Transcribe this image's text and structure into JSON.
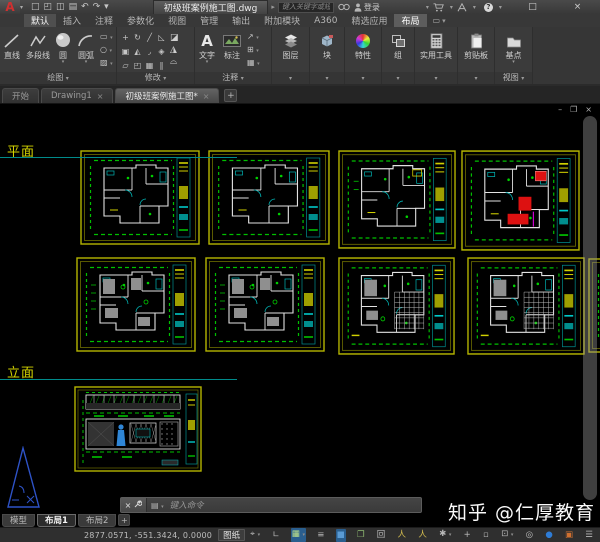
{
  "titlebar": {
    "logo_letter": "A",
    "qat_icons": [
      {
        "name": "new-file-icon",
        "glyph": "□"
      },
      {
        "name": "open-file-icon",
        "glyph": "◰"
      },
      {
        "name": "save-icon",
        "glyph": "◫"
      },
      {
        "name": "plot-icon",
        "glyph": "▤"
      },
      {
        "name": "undo-icon",
        "glyph": "↶"
      },
      {
        "name": "redo-icon",
        "glyph": "↷"
      },
      {
        "name": "qat-dropdown-icon",
        "glyph": "▾"
      }
    ],
    "doc_title": "初级班案例施工图.dwg",
    "search_placeholder": "键入关键字或短语",
    "signin_label": "登录",
    "window_controls": {
      "minimize": "–",
      "maximize": "□",
      "close": "×"
    }
  },
  "ribbon": {
    "tabs": [
      {
        "label": "默认",
        "state": "active"
      },
      {
        "label": "插入",
        "state": ""
      },
      {
        "label": "注释",
        "state": ""
      },
      {
        "label": "参数化",
        "state": ""
      },
      {
        "label": "视图",
        "state": ""
      },
      {
        "label": "管理",
        "state": ""
      },
      {
        "label": "输出",
        "state": ""
      },
      {
        "label": "附加模块",
        "state": ""
      },
      {
        "label": "A360",
        "state": ""
      },
      {
        "label": "精选应用",
        "state": ""
      },
      {
        "label": "布局",
        "state": "selected"
      }
    ],
    "panels": {
      "draw": {
        "label": "绘图",
        "tools": [
          "直线",
          "多段线",
          "圆",
          "圆弧"
        ]
      },
      "modify": {
        "label": "修改"
      },
      "annotate": {
        "label": "注释",
        "tools": [
          "文字",
          "标注"
        ]
      },
      "layers": {
        "label": "图层"
      },
      "block": {
        "label": "块"
      },
      "properties": {
        "label": "特性"
      },
      "group": {
        "label": "组"
      },
      "utilities": {
        "label": "实用工具"
      },
      "clipboard": {
        "label": "剪贴板"
      },
      "view": {
        "label": "视图",
        "tool": "基点"
      }
    },
    "modify_tools": [
      {
        "name": "move-icon",
        "glyph": "+"
      },
      {
        "name": "rotate-icon",
        "glyph": "↻"
      },
      {
        "name": "trim-icon",
        "glyph": "╱"
      },
      {
        "name": "erase-icon",
        "glyph": "◺"
      },
      {
        "name": "copy-icon",
        "glyph": "▣"
      },
      {
        "name": "mirror-icon",
        "glyph": "◭"
      },
      {
        "name": "fillet-icon",
        "glyph": "◞"
      },
      {
        "name": "explode-icon",
        "glyph": "◈"
      },
      {
        "name": "stretch-icon",
        "glyph": "▱"
      },
      {
        "name": "scale-icon",
        "glyph": "◰"
      },
      {
        "name": "array-icon",
        "glyph": "▦"
      },
      {
        "name": "offset-icon",
        "glyph": "∥"
      }
    ],
    "modify_side": [
      {
        "name": "erase-alt-icon",
        "glyph": "◪"
      },
      {
        "name": "join-icon",
        "glyph": "◮"
      },
      {
        "name": "break-icon",
        "glyph": "⌓"
      }
    ],
    "draw_side": [
      {
        "name": "rectangle-icon",
        "glyph": "▭"
      },
      {
        "name": "ellipse-icon",
        "glyph": "○"
      },
      {
        "name": "hatch-icon",
        "glyph": "▨"
      }
    ],
    "annotate_side": [
      {
        "name": "leader-icon",
        "glyph": "↗"
      },
      {
        "name": "table-icon",
        "glyph": "⊞"
      },
      {
        "name": "markup-icon",
        "glyph": "▦"
      }
    ]
  },
  "file_tabs": [
    {
      "label": "开始",
      "closable": false,
      "active": false
    },
    {
      "label": "Drawing1",
      "closable": true,
      "active": false
    },
    {
      "label": "初级班案例施工图*",
      "closable": true,
      "active": true
    }
  ],
  "canvas": {
    "section_labels": [
      {
        "text": "平面",
        "x": 7,
        "y": 37,
        "line_y": 53,
        "line_w": 237
      },
      {
        "text": "立面",
        "x": 7,
        "y": 258,
        "line_y": 275,
        "line_w": 237
      }
    ],
    "plans": [
      {
        "variant": "walls",
        "x": 80,
        "y": 46,
        "w": 120,
        "h": 95
      },
      {
        "variant": "walls",
        "x": 208,
        "y": 46,
        "w": 122,
        "h": 95
      },
      {
        "variant": "walls2",
        "x": 338,
        "y": 46,
        "w": 118,
        "h": 99
      },
      {
        "variant": "red",
        "x": 461,
        "y": 46,
        "w": 119,
        "h": 101
      },
      {
        "variant": "furniture",
        "x": 76,
        "y": 153,
        "w": 120,
        "h": 95
      },
      {
        "variant": "furniture",
        "x": 205,
        "y": 153,
        "w": 120,
        "h": 95
      },
      {
        "variant": "grid",
        "x": 338,
        "y": 153,
        "w": 117,
        "h": 98
      },
      {
        "variant": "grid",
        "x": 467,
        "y": 153,
        "w": 118,
        "h": 98
      },
      {
        "variant": "walls",
        "x": 588,
        "y": 154,
        "w": 120,
        "h": 95
      }
    ],
    "elevation": {
      "x": 74,
      "y": 282,
      "w": 128,
      "h": 86
    },
    "colors": {
      "frame": "#b5b500",
      "frame_inner": "#6e6e00",
      "dims": "#00c000",
      "walls": "#e2e2e2",
      "cyan": "#00b4b4",
      "red": "#dd1111",
      "grey": "#8f8f8f",
      "magenta": "#cc00cc",
      "blue_figure": "#2f86d6",
      "ucs_blue": "#2e53c8"
    }
  },
  "command_line": {
    "placeholder": "键入命令",
    "icons": [
      {
        "name": "close-command-icon",
        "glyph": "×"
      },
      {
        "name": "wrench-icon",
        "glyph": "⚙"
      }
    ]
  },
  "layout_tabs": [
    {
      "label": "模型",
      "active": false
    },
    {
      "label": "布局1",
      "active": true
    },
    {
      "label": "布局2",
      "active": false
    }
  ],
  "status_bar": {
    "coordinates": "2877.0571, -551.3424, 0.0000",
    "space_label": "图纸",
    "icons": [
      {
        "name": "osnap-tracking-icon",
        "glyph": "⌖",
        "caret": true,
        "active": false,
        "color": ""
      },
      {
        "name": "ortho-mode-icon",
        "glyph": "∟",
        "caret": false,
        "active": false,
        "color": ""
      },
      {
        "name": "snap-grid-icon",
        "glyph": "▦",
        "caret": true,
        "active": true,
        "color": "#bde08a"
      },
      {
        "name": "lineweight-icon",
        "glyph": "≡",
        "caret": false,
        "active": false,
        "color": ""
      },
      {
        "name": "transparency-icon",
        "glyph": "■",
        "caret": false,
        "active": true,
        "color": "#5a9bd4"
      },
      {
        "name": "selection-cycling-icon",
        "glyph": "❐",
        "caret": false,
        "active": false,
        "color": "#8fba72"
      },
      {
        "name": "dynamic-ucs-icon",
        "glyph": "回",
        "caret": false,
        "active": false,
        "color": ""
      },
      {
        "name": "annotation-visibility-icon",
        "glyph": "人",
        "caret": false,
        "active": false,
        "color": "#d8c050"
      },
      {
        "name": "autoscale-icon",
        "glyph": "人",
        "caret": false,
        "active": false,
        "color": "#d8c050"
      },
      {
        "name": "annotation-scale-icon",
        "glyph": "✱",
        "caret": true,
        "active": false,
        "color": ""
      },
      {
        "name": "workspace-switch-icon",
        "glyph": "+",
        "caret": false,
        "active": false,
        "color": ""
      },
      {
        "name": "units-icon",
        "glyph": "▫",
        "caret": false,
        "active": false,
        "color": ""
      },
      {
        "name": "quick-properties-icon",
        "glyph": "⊡",
        "caret": true,
        "active": false,
        "color": ""
      },
      {
        "name": "isolate-objects-icon",
        "glyph": "◎",
        "caret": false,
        "active": false,
        "color": ""
      },
      {
        "name": "graphics-performance-icon",
        "glyph": "●",
        "caret": false,
        "active": false,
        "color": "#2e7cd6"
      },
      {
        "name": "clean-screen-icon",
        "glyph": "▣",
        "caret": false,
        "active": false,
        "color": "#d07030"
      },
      {
        "name": "customization-icon",
        "glyph": "☰",
        "caret": false,
        "active": false,
        "color": ""
      }
    ]
  },
  "watermark": "知乎 @仁厚教育"
}
